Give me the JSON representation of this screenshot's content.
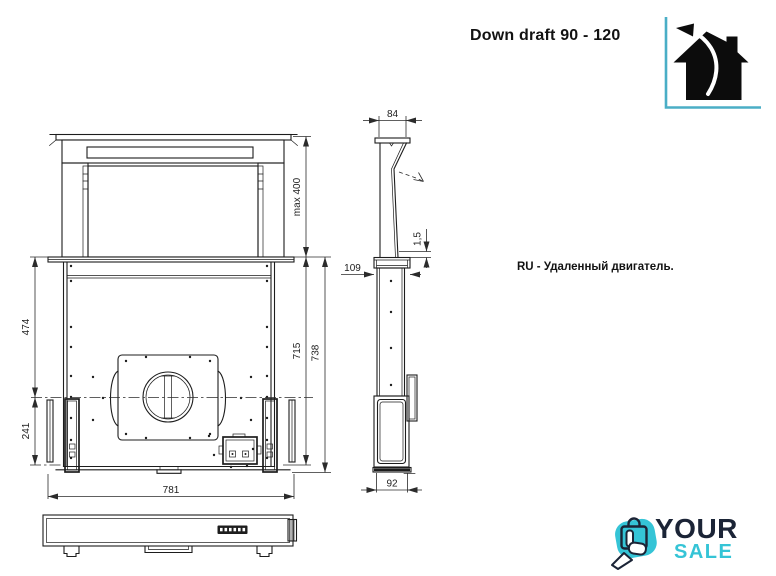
{
  "title": "Down draft 90 - 120",
  "note_ru": "RU - Удаленный двигатель.",
  "colors": {
    "drawing_line": "#1d1d1d",
    "accent_teal": "#4aaec6",
    "logo_navy": "#1b2436",
    "logo_cyan": "#35c4d6"
  },
  "front_view": {
    "dims": {
      "lift_height": "max 400",
      "body_height": "715",
      "total_height": "738",
      "upper_section": "474",
      "lower_section": "241",
      "width": "781"
    }
  },
  "side_view": {
    "dims": {
      "top_depth": "84",
      "panel_gap": "1,5",
      "flange_depth": "109",
      "body_depth": "92"
    }
  },
  "logo": {
    "word_top": "YOUR",
    "word_bottom": "SALE"
  },
  "icons": {
    "house_exhaust": "house-exhaust-icon",
    "logo_mark": "hand-shopping-bag-icon"
  }
}
